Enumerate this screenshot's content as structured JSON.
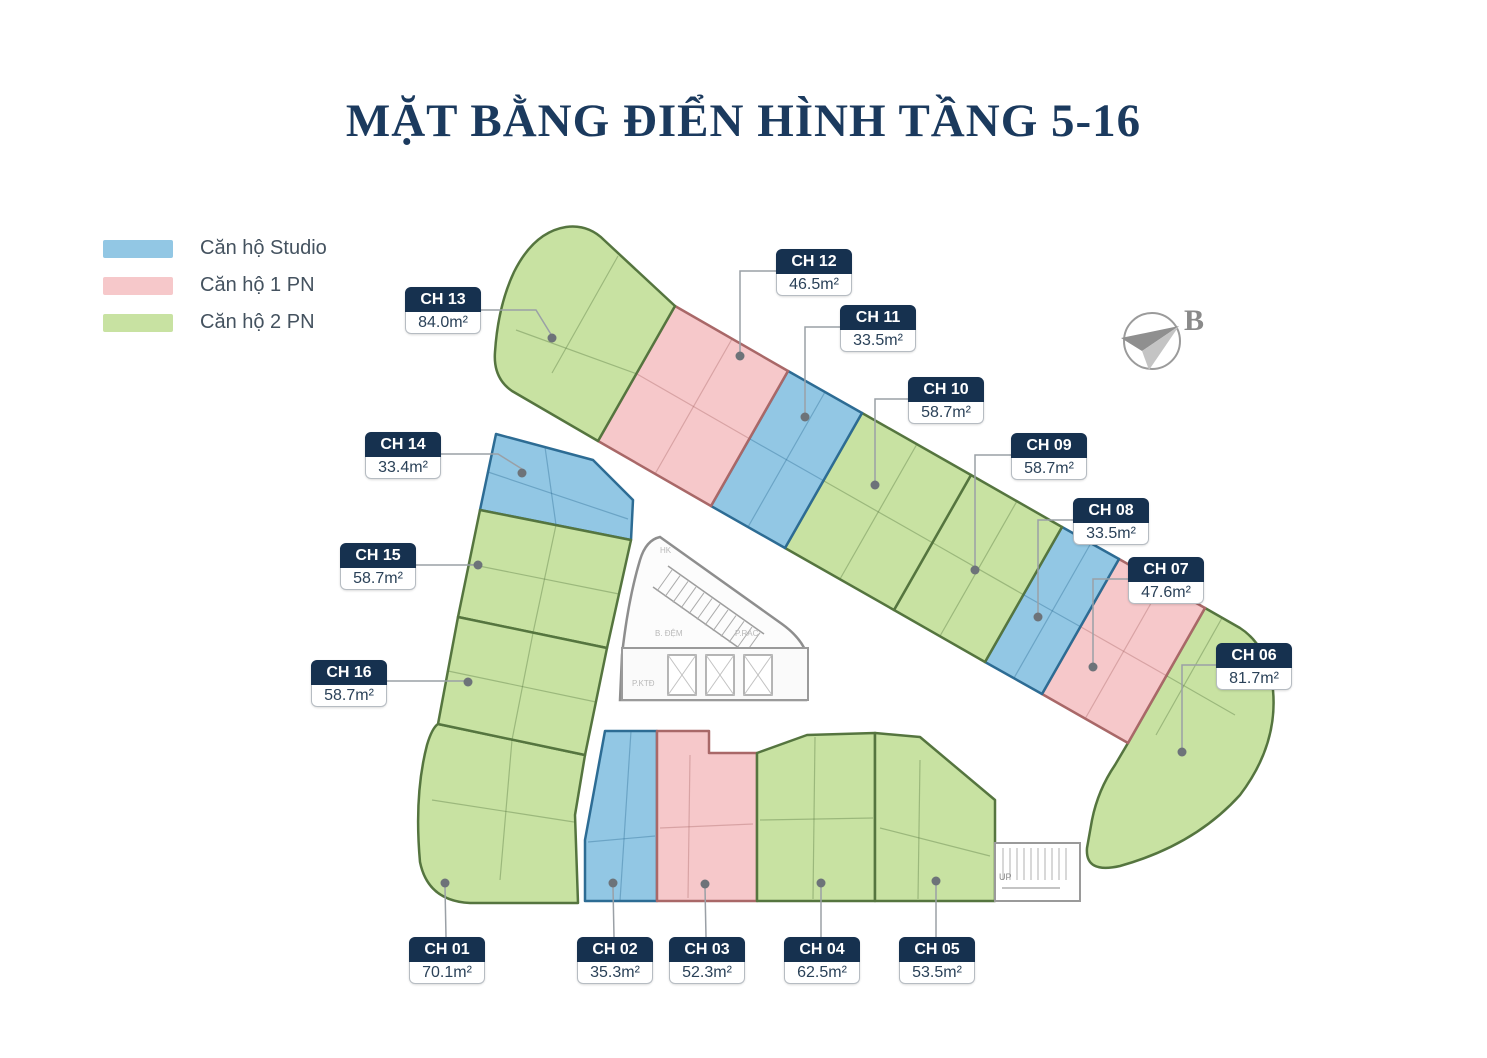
{
  "title": "MẶT BẰNG ĐIỂN HÌNH TẦNG 5-16",
  "legend": {
    "items": [
      {
        "label": "Căn hộ Studio",
        "type": "studio",
        "color": "#92c7e4"
      },
      {
        "label": "Căn hộ 1 PN",
        "type": "1pn",
        "color": "#f6c8ca"
      },
      {
        "label": "Căn hộ 2 PN",
        "type": "2pn",
        "color": "#c8e2a2"
      }
    ]
  },
  "compass": {
    "label": "B"
  },
  "units": [
    {
      "id": "ch01",
      "name": "CH 01",
      "area": "70.1m²",
      "type": "2pn"
    },
    {
      "id": "ch02",
      "name": "CH 02",
      "area": "35.3m²",
      "type": "studio"
    },
    {
      "id": "ch03",
      "name": "CH 03",
      "area": "52.3m²",
      "type": "1pn"
    },
    {
      "id": "ch04",
      "name": "CH 04",
      "area": "62.5m²",
      "type": "2pn"
    },
    {
      "id": "ch05",
      "name": "CH 05",
      "area": "53.5m²",
      "type": "2pn"
    },
    {
      "id": "ch06",
      "name": "CH 06",
      "area": "81.7m²",
      "type": "2pn"
    },
    {
      "id": "ch07",
      "name": "CH 07",
      "area": "47.6m²",
      "type": "1pn"
    },
    {
      "id": "ch08",
      "name": "CH 08",
      "area": "33.5m²",
      "type": "studio"
    },
    {
      "id": "ch09",
      "name": "CH 09",
      "area": "58.7m²",
      "type": "2pn"
    },
    {
      "id": "ch10",
      "name": "CH 10",
      "area": "58.7m²",
      "type": "2pn"
    },
    {
      "id": "ch11",
      "name": "CH 11",
      "area": "33.5m²",
      "type": "studio"
    },
    {
      "id": "ch12",
      "name": "CH 12",
      "area": "46.5m²",
      "type": "1pn"
    },
    {
      "id": "ch13",
      "name": "CH 13",
      "area": "84.0m²",
      "type": "2pn"
    },
    {
      "id": "ch14",
      "name": "CH 14",
      "area": "33.4m²",
      "type": "studio"
    },
    {
      "id": "ch15",
      "name": "CH 15",
      "area": "58.7m²",
      "type": "2pn"
    },
    {
      "id": "ch16",
      "name": "CH 16",
      "area": "58.7m²",
      "type": "2pn"
    }
  ],
  "core": {
    "labels": [
      "HK",
      "B. ĐỆM",
      "P.RÁC",
      "P.KTĐ",
      "UP"
    ]
  },
  "colors": {
    "outline_studio": "#2d6c94",
    "outline_1pn": "#a96868",
    "outline_2pn": "#55753f",
    "label_header_bg": "#16314f",
    "label_text": "#2a4158",
    "leader": "#9aa0a6",
    "leader_dot": "#6d7379",
    "title": "#1b3a5e",
    "legend_text": "#44525f",
    "core_gray": "#9a9a9a"
  }
}
